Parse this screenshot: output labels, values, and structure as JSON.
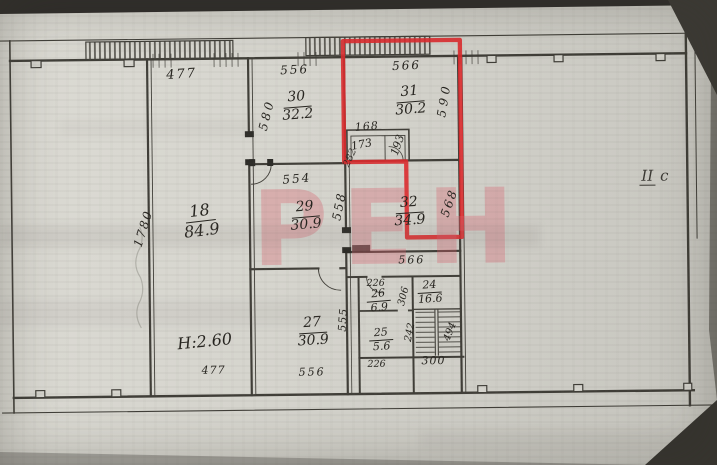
{
  "colors": {
    "red_outline": "#dd2a2e",
    "watermark_pink": "#d96570",
    "ink": "#26241f"
  },
  "watermark": {
    "text": "РЕН"
  },
  "floor_label": {
    "roman": "II",
    "suffix": "с"
  },
  "rooms": {
    "r18": {
      "number": "18",
      "area": "84.9"
    },
    "r30": {
      "number": "30",
      "area": "32.2"
    },
    "r31": {
      "number": "31",
      "area": "30.2"
    },
    "r29": {
      "number": "29",
      "area": "30.9"
    },
    "r32": {
      "number": "32",
      "area": "34.9"
    },
    "r27": {
      "number": "27",
      "area": "30.9"
    },
    "r26": {
      "number": "26",
      "area": "6.9"
    },
    "r24": {
      "number": "24",
      "area": "16.6"
    },
    "r25": {
      "number": "25",
      "area": "5.6"
    }
  },
  "dims": {
    "top_477": "477",
    "r30_top": "556",
    "r30_left": "580",
    "r31_top": "566",
    "r31_right": "590",
    "closet_top": "168",
    "closet_inner": "173",
    "closet_right": "193",
    "closet_left": "282",
    "r29_top": "554",
    "r29_right": "558",
    "r32_right": "568",
    "r32_bottom": "566",
    "r18_side": "1780",
    "r18_bottom": "477",
    "r18_height": "Н:2.60",
    "r27_right": "555",
    "r27_bottom": "556",
    "r26_top": "226",
    "r26_right": "306",
    "r25_bottom": "226",
    "r25_right": "242",
    "stair_width": "300",
    "stair_flight": "494"
  }
}
